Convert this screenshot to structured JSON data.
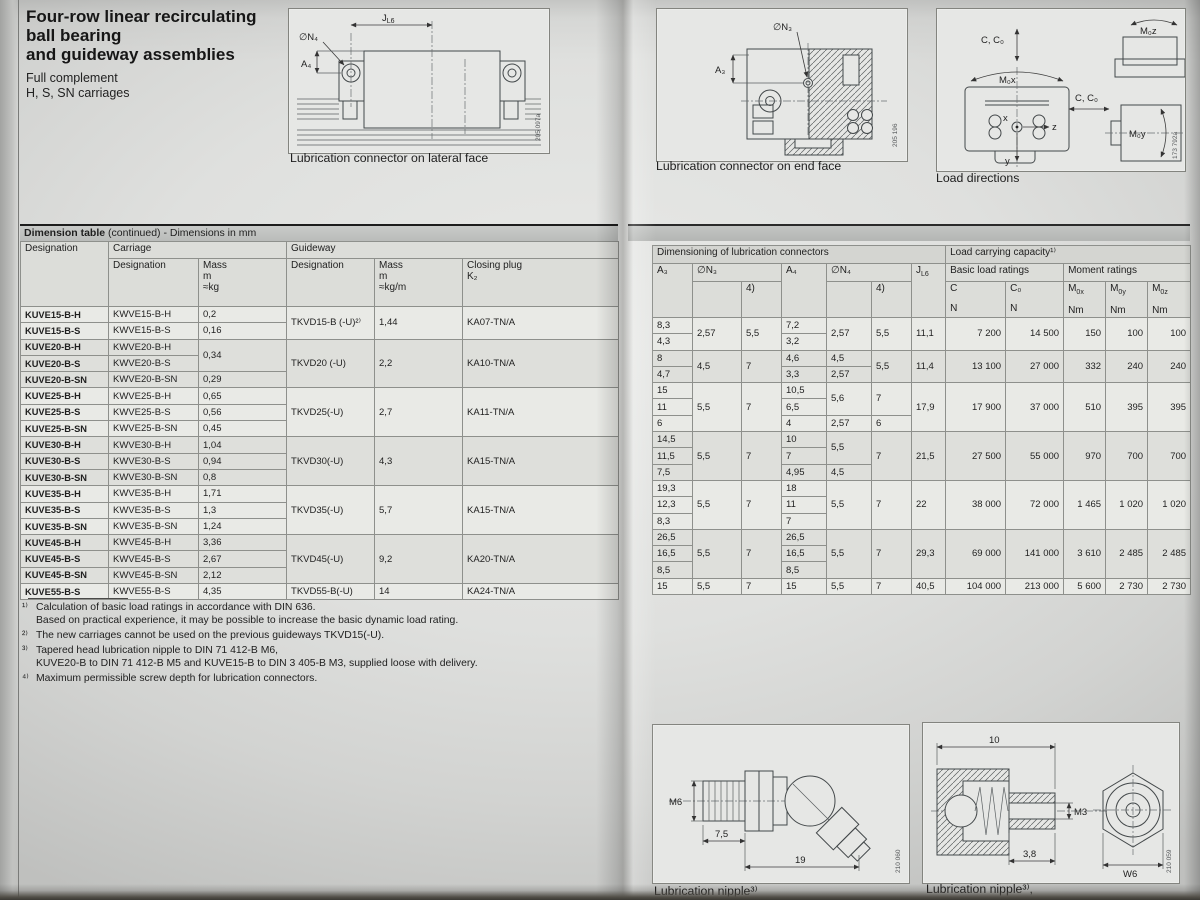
{
  "header": {
    "title_lines": [
      "Four-row linear recirculating",
      "ball bearing",
      "and guideway assemblies"
    ],
    "subtitle_lines": [
      "Full complement",
      "H, S, SN carriages"
    ]
  },
  "figures": {
    "lateral": {
      "caption": "Lubrication connector on lateral face",
      "ref": "205 097a",
      "labels": {
        "j_base": "J",
        "j_sub": "L6",
        "n4": "∅N₄",
        "a4": "A₄"
      }
    },
    "endface": {
      "caption": "Lubrication connector on end face",
      "ref": "205 196",
      "labels": {
        "n3": "∅N₃",
        "a3": "A₃"
      }
    },
    "load": {
      "caption": "Load directions",
      "ref": "173 792a",
      "labels": {
        "cc0": "C, C₀",
        "m0x": "M₀x",
        "m0y": "M₀y",
        "m0z": "M₀z",
        "x": "x",
        "y": "y",
        "z": "z"
      }
    },
    "nippleA": {
      "caption": "Lubrication nipple³⁾",
      "ref": "210 060",
      "dims": {
        "thread": "M6",
        "l1": "7,5",
        "l2": "19"
      }
    },
    "nippleB": {
      "caption": "Lubrication nipple³⁾,",
      "ref": "210 059",
      "dims": {
        "l": "10",
        "thread": "M3",
        "l2": "3,8",
        "hex": "W6"
      }
    }
  },
  "table": {
    "bar": {
      "bold": "Dimension table",
      "rest": " (continued) - Dimensions in mm"
    },
    "left": {
      "h": {
        "designation": "Designation",
        "carriage": "Carriage",
        "guideway": "Guideway",
        "sub_designation": "Designation",
        "mass": "Mass",
        "m": "m",
        "kg": "≈kg",
        "kgm": "≈kg/m",
        "closing": "Closing plug",
        "k2": "K₂"
      },
      "groups": [
        {
          "gw": "TKVD15-B (-U)²⁾",
          "gwm": "1,44",
          "plug": "KA07-TN/A",
          "rows": [
            {
              "d": "KUVE15-B-H",
              "c": "KWVE15-B-H",
              "m": "0,2"
            },
            {
              "d": "KUVE15-B-S",
              "c": "KWVE15-B-S",
              "m": "0,16"
            }
          ]
        },
        {
          "gw": "TKVD20 (-U)",
          "gwm": "2,2",
          "plug": "KA10-TN/A",
          "rows": [
            {
              "d": "KUVE20-B-H",
              "c": "KWVE20-B-H",
              "m": "0,34",
              "mspan": 2
            },
            {
              "d": "KUVE20-B-S",
              "c": "KWVE20-B-S"
            },
            {
              "d": "KUVE20-B-SN",
              "c": "KWVE20-B-SN",
              "m": "0,29"
            }
          ]
        },
        {
          "gw": "TKVD25(-U)",
          "gwm": "2,7",
          "plug": "KA11-TN/A",
          "rows": [
            {
              "d": "KUVE25-B-H",
              "c": "KWVE25-B-H",
              "m": "0,65"
            },
            {
              "d": "KUVE25-B-S",
              "c": "KWVE25-B-S",
              "m": "0,56"
            },
            {
              "d": "KUVE25-B-SN",
              "c": "KWVE25-B-SN",
              "m": "0,45"
            }
          ]
        },
        {
          "gw": "TKVD30(-U)",
          "gwm": "4,3",
          "plug": "KA15-TN/A",
          "rows": [
            {
              "d": "KUVE30-B-H",
              "c": "KWVE30-B-H",
              "m": "1,04"
            },
            {
              "d": "KUVE30-B-S",
              "c": "KWVE30-B-S",
              "m": "0,94"
            },
            {
              "d": "KUVE30-B-SN",
              "c": "KWVE30-B-SN",
              "m": "0,8"
            }
          ]
        },
        {
          "gw": "TKVD35(-U)",
          "gwm": "5,7",
          "plug": "KA15-TN/A",
          "rows": [
            {
              "d": "KUVE35-B-H",
              "c": "KWVE35-B-H",
              "m": "1,71"
            },
            {
              "d": "KUVE35-B-S",
              "c": "KWVE35-B-S",
              "m": "1,3"
            },
            {
              "d": "KUVE35-B-SN",
              "c": "KWVE35-B-SN",
              "m": "1,24"
            }
          ]
        },
        {
          "gw": "TKVD45(-U)",
          "gwm": "9,2",
          "plug": "KA20-TN/A",
          "rows": [
            {
              "d": "KUVE45-B-H",
              "c": "KWVE45-B-H",
              "m": "3,36"
            },
            {
              "d": "KUVE45-B-S",
              "c": "KWVE45-B-S",
              "m": "2,67"
            },
            {
              "d": "KUVE45-B-SN",
              "c": "KWVE45-B-SN",
              "m": "2,12"
            }
          ]
        },
        {
          "gw": "TKVD55-B(-U)",
          "gwm": "14",
          "plug": "KA24-TN/A",
          "rows": [
            {
              "d": "KUVE55-B-S",
              "c": "KWVE55-B-S",
              "m": "4,35"
            }
          ]
        }
      ]
    },
    "right": {
      "h": {
        "dim": "Dimensioning of lubrication connectors",
        "load": "Load carrying capacity¹⁾",
        "basic": "Basic load ratings",
        "moment": "Moment ratings",
        "a3": "A₃",
        "n3": "∅N₃",
        "note4": "4)",
        "a4": "A₄",
        "n4": "∅N₄",
        "j_base": "J",
        "j_sub": "L6",
        "c": "C",
        "c0": "C₀",
        "m_base": "M",
        "m0x": "0x",
        "m0y": "0y",
        "m0z": "0z",
        "n_unit": "N",
        "nm_unit": "Nm"
      },
      "groups": [
        {
          "slots": 2,
          "a3": [
            "8,3",
            "4,3"
          ],
          "n3": "2,57",
          "n3d": "5,5",
          "a4": [
            "7,2",
            "3,2"
          ],
          "n4": "2,57",
          "n4d": "5,5",
          "jl6": "11,1",
          "c": "7 200",
          "c0": "14 500",
          "m0x": "150",
          "m0y": "100",
          "m0z": "100"
        },
        {
          "slots": 3,
          "a3": [
            {
              "v": "8",
              "span": 2
            },
            "4,7"
          ],
          "n3": "4,5",
          "n3d": "7",
          "a4": [
            {
              "v": "4,6",
              "span": 2
            },
            "3,3"
          ],
          "n4": [
            {
              "v": "4,5",
              "span": 2
            },
            "2,57"
          ],
          "n4d": "5,5",
          "jl6": "11,4",
          "c": "13 100",
          "c0": "27 000",
          "m0x": "332",
          "m0y": "240",
          "m0z": "240"
        },
        {
          "slots": 3,
          "a3": [
            "15",
            "11",
            "6"
          ],
          "n3": "5,5",
          "n3d": "7",
          "a4": [
            "10,5",
            "6,5",
            "4"
          ],
          "n4": [
            {
              "v": "5,6",
              "span": 2
            },
            "2,57"
          ],
          "n4d": [
            {
              "v": "7",
              "span": 2
            },
            "6"
          ],
          "jl6": "17,9",
          "c": "17 900",
          "c0": "37 000",
          "m0x": "510",
          "m0y": "395",
          "m0z": "395"
        },
        {
          "slots": 3,
          "a3": [
            "14,5",
            "11,5",
            "7,5"
          ],
          "n3": "5,5",
          "n3d": "7",
          "a4": [
            "10",
            "7",
            "4,95"
          ],
          "n4": [
            {
              "v": "5,5",
              "span": 2
            },
            "4,5"
          ],
          "n4d": "7",
          "jl6": "21,5",
          "c": "27 500",
          "c0": "55 000",
          "m0x": "970",
          "m0y": "700",
          "m0z": "700"
        },
        {
          "slots": 3,
          "a3": [
            "19,3",
            "12,3",
            "8,3"
          ],
          "n3": "5,5",
          "n3d": "7",
          "a4": [
            "18",
            "11",
            "7"
          ],
          "n4": "5,5",
          "n4d": "7",
          "jl6": "22",
          "c": "38 000",
          "c0": "72 000",
          "m0x": "1 465",
          "m0y": "1 020",
          "m0z": "1 020"
        },
        {
          "slots": 3,
          "a3": [
            "26,5",
            "16,5",
            "8,5"
          ],
          "n3": "5,5",
          "n3d": "7",
          "a4": [
            "26,5",
            "16,5",
            "8,5"
          ],
          "n4": "5,5",
          "n4d": "7",
          "jl6": "29,3",
          "c": "69 000",
          "c0": "141 000",
          "m0x": "3 610",
          "m0y": "2 485",
          "m0z": "2 485"
        },
        {
          "slots": 1,
          "a3": [
            "15"
          ],
          "n3": "5,5",
          "n3d": "7",
          "a4": [
            "15"
          ],
          "n4": "5,5",
          "n4d": "7",
          "jl6": "40,5",
          "c": "104 000",
          "c0": "213 000",
          "m0x": "5 600",
          "m0y": "2 730",
          "m0z": "2 730"
        }
      ]
    }
  },
  "footnotes": [
    {
      "marker": "¹⁾",
      "lines": [
        "Calculation of basic load ratings in accordance with DIN 636.",
        "Based on practical experience, it may be possible to increase the basic dynamic load rating."
      ]
    },
    {
      "marker": "²⁾",
      "lines": [
        "The new carriages cannot be used on the previous guideways TKVD15(-U)."
      ]
    },
    {
      "marker": "³⁾",
      "lines": [
        "Tapered head lubrication nipple to DIN 71 412-B M6,",
        "KUVE20-B to DIN 71 412-B M5 and KUVE15-B to DIN 3 405-B M3, supplied loose with delivery."
      ]
    },
    {
      "marker": "⁴⁾",
      "lines": [
        "Maximum permissible screw depth for lubrication connectors."
      ]
    }
  ]
}
